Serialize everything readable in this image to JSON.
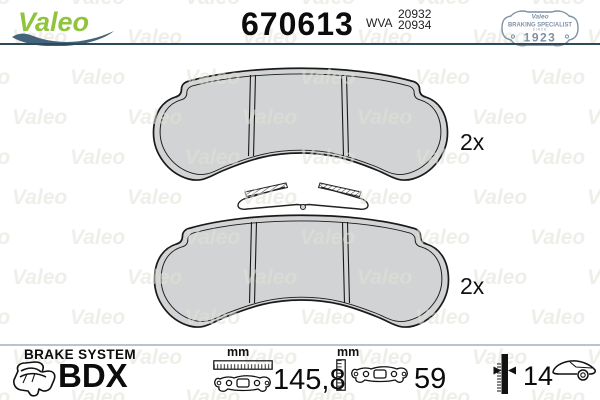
{
  "header": {
    "brand": "Valeo",
    "part_number": "670613",
    "wva_label": "WVA",
    "wva_numbers": [
      "20932",
      "20934"
    ],
    "badge": {
      "brand": "Valeo",
      "title": "BRAKING SPECIALIST",
      "since": "SINCE",
      "year": "1923"
    }
  },
  "product": {
    "items": [
      {
        "type": "brake-pad",
        "quantity_label": "2x"
      },
      {
        "type": "brake-pad-with-spring-clip",
        "quantity_label": "2x"
      }
    ]
  },
  "footer": {
    "brake_system_label": "BRAKE SYSTEM",
    "brake_system_value": "BDX",
    "measurements": {
      "width": {
        "unit": "mm",
        "value": "145,8"
      },
      "height": {
        "unit": "mm",
        "value": "59"
      },
      "thickness": {
        "value": "14"
      }
    }
  },
  "watermark": "Valeo",
  "colors": {
    "valeo_green": "#8fc43c",
    "swoosh_blue": "#44647a",
    "badge_blue": "#7f91a5",
    "divider_dark": "#2c4a5c",
    "divider_light": "#b9c5ce",
    "pad_fill": "#d2d3d5",
    "outline": "#1a1a1a"
  }
}
